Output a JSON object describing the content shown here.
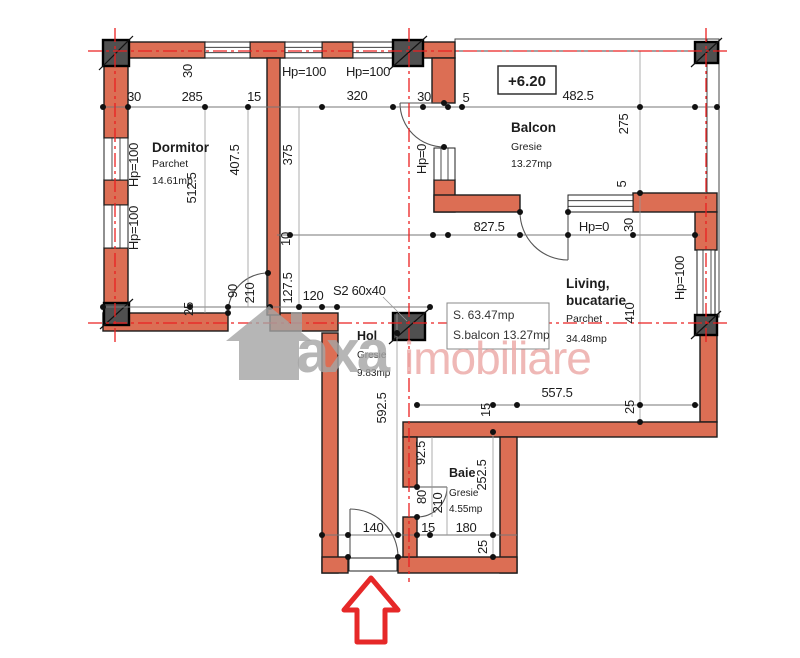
{
  "watermark": {
    "brand_left": "axa",
    "brand_right": "imobiliare"
  },
  "colors": {
    "wall": "#dc6e54",
    "axis_red": "#ea2020",
    "column": "#505050",
    "watermark_gray": "#a5a5a5",
    "watermark_pink": "#edacaa",
    "arrow_red": "#e62828"
  },
  "plan": {
    "level": "+6.20",
    "column_label": "S2 60x40",
    "rooms": {
      "dormitor": {
        "name": "Dormitor",
        "finish": "Parchet",
        "area": "14.61mp"
      },
      "balcon": {
        "name": "Balcon",
        "finish": "Gresie",
        "area": "13.27mp"
      },
      "living": {
        "name1": "Living,",
        "name2": "bucatarie",
        "finish": "Parchet",
        "area": "34.48mp"
      },
      "hol": {
        "name": "Hol",
        "finish": "Gresie",
        "area": "9.83mp"
      },
      "baie": {
        "name": "Baie",
        "finish": "Gresie",
        "area": "4.55mp"
      }
    },
    "summary": {
      "total": "S. 63.47mp",
      "balcony": "S.balcon 13.27mp"
    },
    "parapets": {
      "top1": "Hp=100",
      "top2": "Hp=100",
      "left1": "Hp=100",
      "left2": "Hp=100",
      "door_top": "Hp=0",
      "mid": "Hp=0",
      "right": "Hp=100"
    },
    "dims": {
      "top_30l": "30",
      "top_285": "285",
      "top_15": "15",
      "top_320": "320",
      "top_30r": "30",
      "top_5": "5",
      "top_482": "482.5",
      "v_30": "30",
      "v_512": "512.5",
      "v_407": "407.5",
      "v_375": "375",
      "v_275": "275",
      "v_5": "5",
      "v_410": "410",
      "mid_827": "827.5",
      "mid_30": "30",
      "h_25": "25",
      "h_90": "90",
      "h_210": "210",
      "h_127": "127.5",
      "h_120": "120",
      "h_10": "10",
      "h_592": "592.5",
      "h_557": "557.5",
      "h_15": "15",
      "h_25r": "25",
      "b_92": "92.5",
      "b_80": "80",
      "b_210": "210",
      "b_252": "252.5",
      "b_15": "15",
      "b_180": "180",
      "b_140": "140",
      "b_25": "25"
    }
  }
}
